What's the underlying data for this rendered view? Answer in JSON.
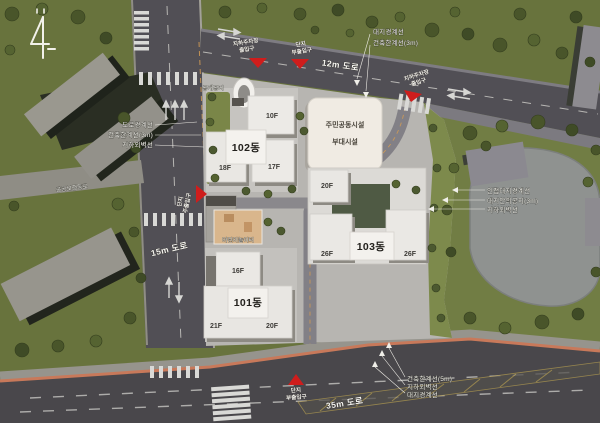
{
  "boundary_labels": {
    "left": [
      "도로경계선",
      "건축한계선(3m)",
      "지하외벽선"
    ],
    "top": [
      "대지경계선",
      "건축한계선(3m)"
    ],
    "right": [
      "인접대지경계선",
      "대지안의공지(3m)",
      "지하외벽선"
    ],
    "bottom": [
      "건축한계선(5m)",
      "지하외벽선",
      "대지경계선"
    ]
  },
  "roads": {
    "r12": "12m 도로",
    "r15": "15m 도로",
    "r35": "35m 도로",
    "pedestrian": "공공보행통로"
  },
  "site": {
    "open_space": "공개공지",
    "playground": "어린이놀이터",
    "community": {
      "line1": "주민공동시설",
      "line2": "부대시설"
    },
    "b102": {
      "name": "102동",
      "f_top": "10F",
      "f_left": "18F",
      "f_right": "17F"
    },
    "b101": {
      "name": "101동",
      "f_top": "16F",
      "f_left": "21F",
      "f_right": "20F"
    },
    "b103": {
      "name": "103동",
      "f_top": "20F",
      "f_left": "26F",
      "f_right": "26F"
    }
  },
  "entrances": {
    "main": {
      "l1": "단지",
      "l2": "주출입구"
    },
    "sub_top": {
      "l1": "단지",
      "l2": "부출입구"
    },
    "sub_bottom": {
      "l1": "단지",
      "l2": "부출입구"
    },
    "parking_top": {
      "l1": "지하주차장",
      "l2": "출입구"
    },
    "parking_right": {
      "l1": "지하주차장",
      "l2": "출입구"
    }
  },
  "colors": {
    "green_base": "#68733d",
    "park_green": "#717d44",
    "road_gray": "#504e54",
    "accent_red": "#cf1d1c",
    "curb_orange": "#c8795a",
    "building_white": "#eceae6"
  }
}
